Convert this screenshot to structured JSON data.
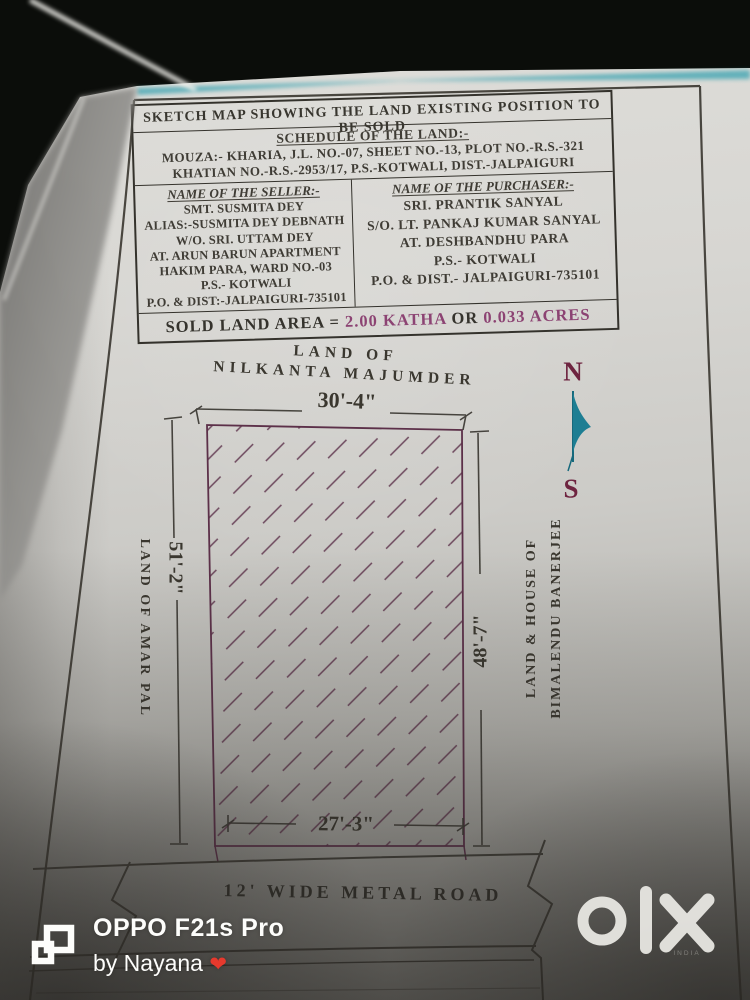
{
  "photo": {
    "watermark_device": "OPPO F21s Pro",
    "watermark_author": "by Nayana",
    "watermark_heart": "❤",
    "brand": "olx",
    "brand_sub": "INDIA"
  },
  "document": {
    "title": "SKETCH MAP SHOWING THE  LAND EXISTING  POSITION TO BE SOLD",
    "schedule": {
      "heading": "SCHEDULE OF THE LAND:-",
      "line1": "MOUZA:- KHARIA, J.L. NO.-07, SHEET NO.-13, PLOT NO.-R.S.-321",
      "line2": "KHATIAN NO.-R.S.-2953/17,  P.S.-KOTWALI, DIST.-JALPAIGURI"
    },
    "seller": {
      "heading": "NAME OF THE  SELLER:-",
      "lines": [
        "SMT. SUSMITA DEY",
        "ALIAS:-SUSMITA DEY DEBNATH",
        "W/O. SRI. UTTAM DEY",
        "AT. ARUN BARUN APARTMENT",
        "HAKIM PARA, WARD NO.-03",
        "P.S.- KOTWALI",
        "P.O. & DIST:-JALPAIGURI-735101"
      ]
    },
    "purchaser": {
      "heading": "NAME OF THE  PURCHASER:-",
      "lines": [
        "SRI. PRANTIK  SANYAL",
        "S/O. LT. PANKAJ KUMAR SANYAL",
        "AT. DESHBANDHU PARA",
        "P.S.- KOTWALI",
        "P.O. & DIST.- JALPAIGURI-735101"
      ]
    },
    "sold_area": {
      "prefix": "SOLD LAND AREA = ",
      "kata": "2.00 KATHA",
      "conj": " OR ",
      "acres": "0.033 ACRES"
    },
    "map": {
      "north_owner_line1": "LAND OF",
      "north_owner_line2": "NILKANTA MAJUMDER",
      "top_dim": "30'-4\"",
      "left_dim": "51'-2\"",
      "left_owner": "LAND OF AMAR PAL",
      "right_dim": "48'-7\"",
      "right_owner_line1": "LAND & HOUSE OF",
      "right_owner_line2": "BIMALENDU BANERJEE",
      "bottom_dim": "27'-3\"",
      "road_label": "12' WIDE METAL ROAD",
      "compass_north": "N",
      "compass_south": "S"
    },
    "colors": {
      "value_accent": "#8c4373",
      "plot_line": "#5c3049",
      "compass_letter": "#6e2440",
      "compass_arrow": "#1d7e93"
    }
  }
}
